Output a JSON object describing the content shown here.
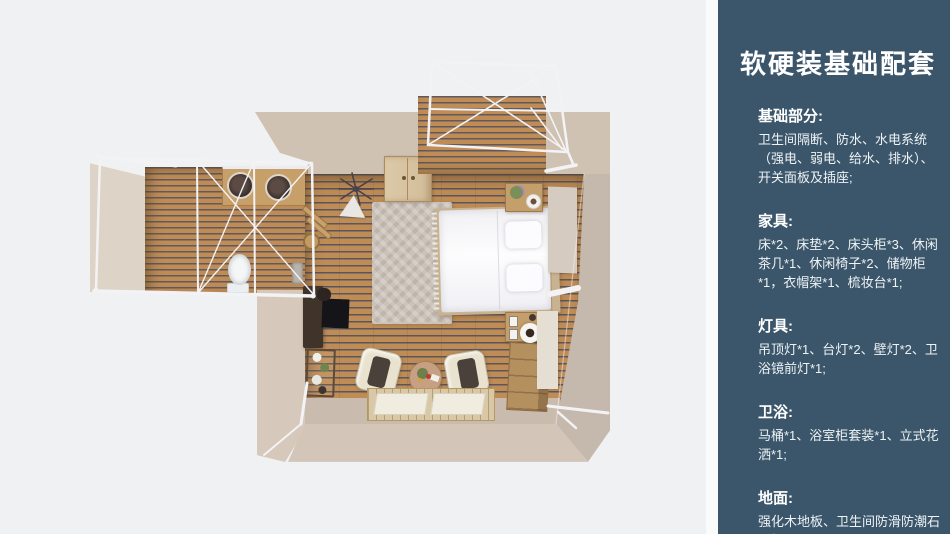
{
  "theme": {
    "page_bg": "#f0f1f2",
    "sidebar_bg": "#3b566a",
    "sidebar_strip": "#fafbfb",
    "sidebar_text": "#eef3f5",
    "fp_wood": "#bf8c55",
    "fp_wall_top": "#cfc2b3",
    "fp_wall_left": "#d6c9bb",
    "fp_wall_right": "#c5b8ac",
    "fp_wall_bottom": "#d3c5b8",
    "fp_bath_wall": "#ddd3c6",
    "fp_floor_strip": "#c9bbae",
    "fp_frame": "#f3f3f6",
    "fp_rug": "#cbc2b9",
    "fp_deck": "#d9c8a6",
    "fp_wood_furn": "#c49f6b",
    "fp_headboard": "#c9b28f"
  },
  "sidebar": {
    "title": "软硬装基础配套",
    "sections": [
      {
        "heading": "基础部分:",
        "body": "卫生间隔断、防水、水电系统（强电、弱电、给水、排水）、开关面板及插座;"
      },
      {
        "heading": "家具:",
        "body": "床*2、床垫*2、床头柜*3、休闲茶几*1、休闲椅子*2、储物柜*1，衣帽架*1、梳妆台*1;"
      },
      {
        "heading": "灯具:",
        "body": "吊顶灯*1、台灯*2、壁灯*2、卫浴镜前灯*1;"
      },
      {
        "heading": "卫浴:",
        "body": "马桶*1、浴室柜套装*1、立式花洒*1;"
      },
      {
        "heading": "地面:",
        "body": "强化木地板、卫生间防滑防潮石塑板;"
      }
    ]
  }
}
